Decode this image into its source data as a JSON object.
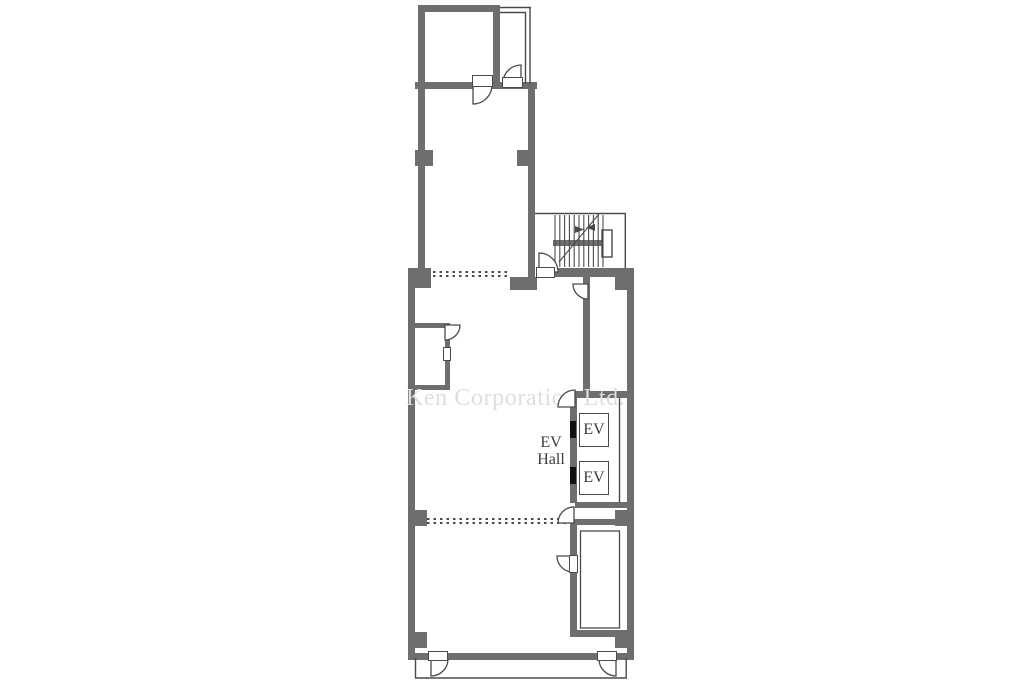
{
  "page": {
    "title": "Floor Plan",
    "width": 1024,
    "height": 683
  },
  "colors": {
    "wall": "#6e6e6e",
    "line": "#4a4a4a",
    "text": "#3c3c3c",
    "watermark": "#dedede",
    "door_marker": "#111111",
    "bg": "#ffffff"
  },
  "watermark": {
    "text": "Ken Corporation Ltd."
  },
  "labels": {
    "ev_hall_line1": "EV",
    "ev_hall_line2": "Hall"
  },
  "elevators": [
    {
      "label": "EV"
    },
    {
      "label": "EV"
    }
  ]
}
